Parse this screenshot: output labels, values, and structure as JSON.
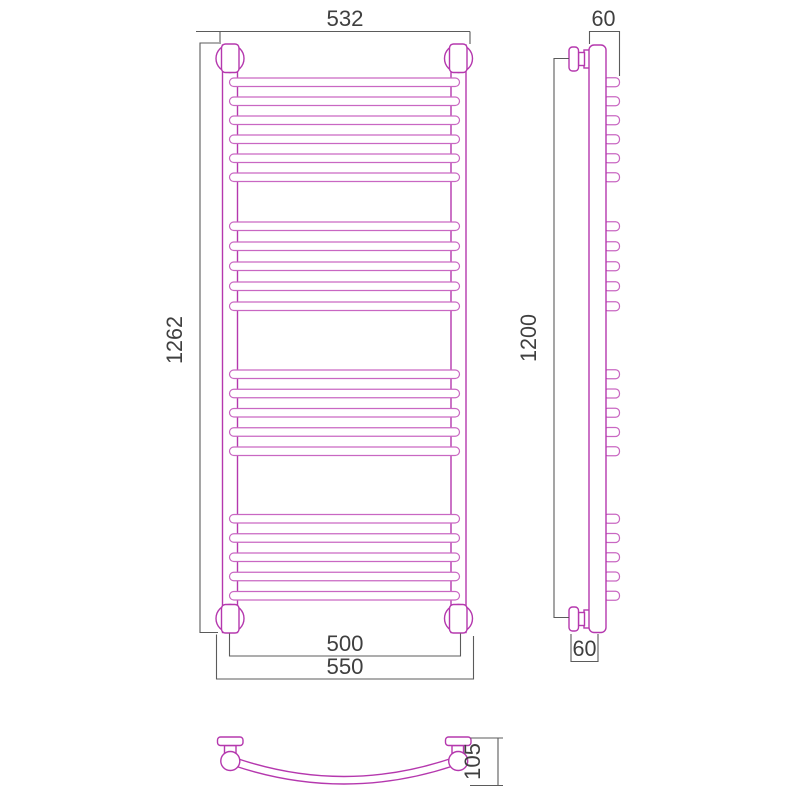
{
  "drawing": {
    "type": "technical-dimension-drawing",
    "subject": "curved ladder towel radiator: front view, side view and top view",
    "colors": {
      "outline": "#b538ae",
      "outline_light": "#c967c2",
      "dimension_lines": "#5b5b5b",
      "text": "#3f3f3f",
      "background": "#ffffff"
    },
    "labels": {
      "width_top": "532",
      "height_overall": "1262",
      "depth_top": "60",
      "height_side": "1200",
      "width_rails": "500",
      "width_mounts": "550",
      "depth_bottom": "60",
      "depth_curve": "105"
    },
    "front_view": {
      "rail_groups": [
        {
          "y_start": 78,
          "count": 6,
          "spacing": 19
        },
        {
          "y_start": 222,
          "count": 5,
          "spacing": 20
        },
        {
          "y_start": 370,
          "count": 5,
          "spacing": 19.25
        },
        {
          "y_start": 514.5,
          "count": 5,
          "spacing": 19.25
        }
      ],
      "total_rails": 21,
      "rail_x": 229.5,
      "rail_w": 230,
      "rail_h": 8.5
    },
    "side_view": {
      "tab_x": 603.5,
      "tab_w": 16,
      "tab_h": 9
    }
  }
}
